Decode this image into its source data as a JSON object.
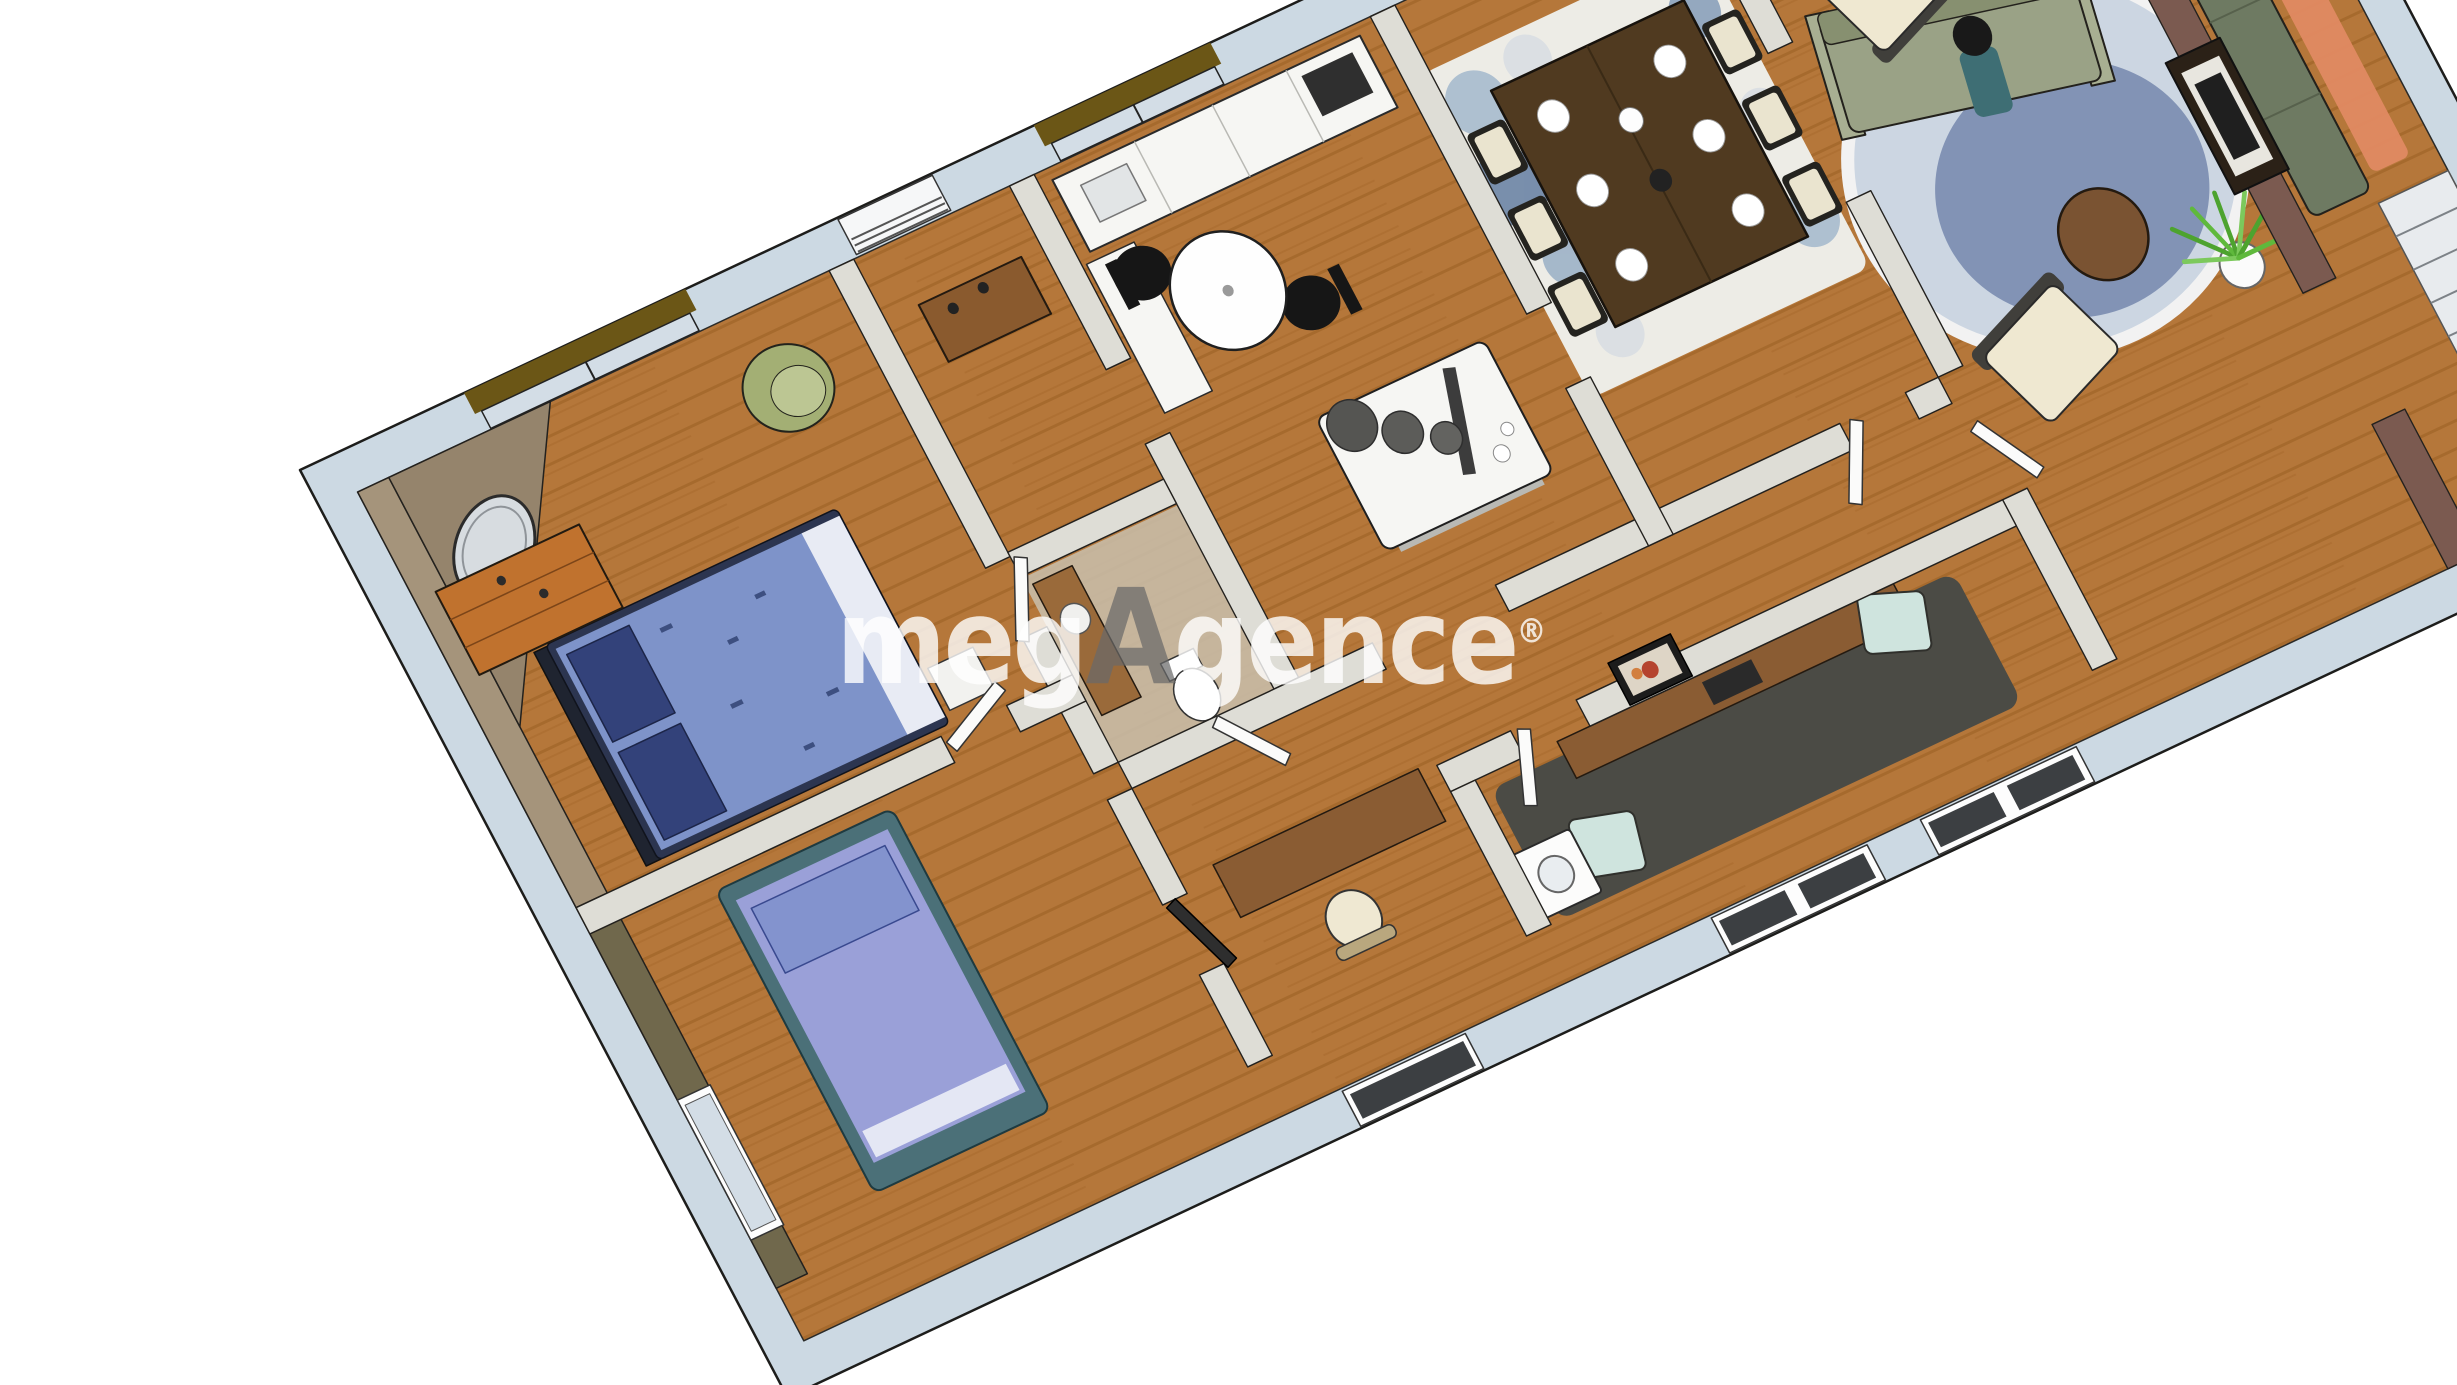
{
  "watermark": {
    "prefix": "meg",
    "accent": "A",
    "suffix": "gence",
    "registered": "®"
  },
  "colors": {
    "wm": "rgba(255,255,255,0.80)",
    "wm-accent": "rgba(105,105,105,0.72)",
    "slab": "#ccd9e3",
    "wall": "#deddd6",
    "wood": "#b5773a",
    "wood-line": "#9f6226",
    "valance": "#6b5616",
    "accent-wall": "#7b5a50",
    "taupe": "#a5947b",
    "olive": "#70684c",
    "bed1-duvet": "#7e93c9",
    "bed1-pillow": "#33427a",
    "bed2-duvet": "#9aa0d8",
    "bed2-frame": "#4b7078",
    "sofa-sage": "#9aa286",
    "sofa-dark": "#6e7a62",
    "armchair-cream": "#efe8d1",
    "rug-blue": "#ccd6e2",
    "rug-blue-inner": "#7487ad",
    "charcoal": "#4b4b45",
    "mint": "#cfe4de",
    "orange-rug": "#e08a62",
    "plant-green": "#4da32f",
    "table-dark": "#503a20",
    "counter-white": "#f6f6f3",
    "glass": "#d3dde6"
  },
  "scene": {
    "type": "3d-floor-plan-perspective",
    "background": "#ffffff",
    "rooms": [
      {
        "name": "bedroom-1",
        "furniture": [
          "double-bed-blue",
          "wood-dresser",
          "round-wall-mirror",
          "green-armchair",
          "white-nightstand",
          "window-with-valance"
        ]
      },
      {
        "name": "bedroom-2",
        "furniture": [
          "single-bed-purple",
          "desk",
          "desk-chair",
          "dark-door",
          "west-window"
        ]
      },
      {
        "name": "entry",
        "furniture": [
          "wood-console",
          "shuttered-window"
        ]
      },
      {
        "name": "bathroom-wc",
        "furniture": [
          "vanity-sink",
          "toilet"
        ]
      },
      {
        "name": "kitchen",
        "furniture": [
          "white-counter",
          "cooktop",
          "sink",
          "kitchen-island",
          "pendant-lamps",
          "bistro-round-table",
          "black-chairs"
        ]
      },
      {
        "name": "dining-room",
        "furniture": [
          "dark-wood-table",
          "white-plates",
          "dining-chairs",
          "circle-pattern-rug",
          "buffet-sideboard",
          "wall-plates",
          "window-with-valance"
        ]
      },
      {
        "name": "living-room",
        "furniture": [
          "sage-sofa",
          "seated-person",
          "round-coffee-table",
          "cream-armchairs",
          "oval-blue-rug",
          "potted-plant",
          "ladder-shelf",
          "windows-with-valance"
        ]
      },
      {
        "name": "stair-room",
        "furniture": [
          "dark-green-sofa",
          "orange-rug",
          "white-staircase",
          "brown-accent-wall",
          "framed-pictures"
        ]
      },
      {
        "name": "office-laundry",
        "furniture": [
          "charcoal-rug",
          "wood-desk",
          "laptop",
          "mint-chairs",
          "washing-machine",
          "red-art-frame",
          "south-windows"
        ]
      },
      {
        "name": "hallway",
        "furniture": [
          "white-doors"
        ]
      }
    ]
  }
}
